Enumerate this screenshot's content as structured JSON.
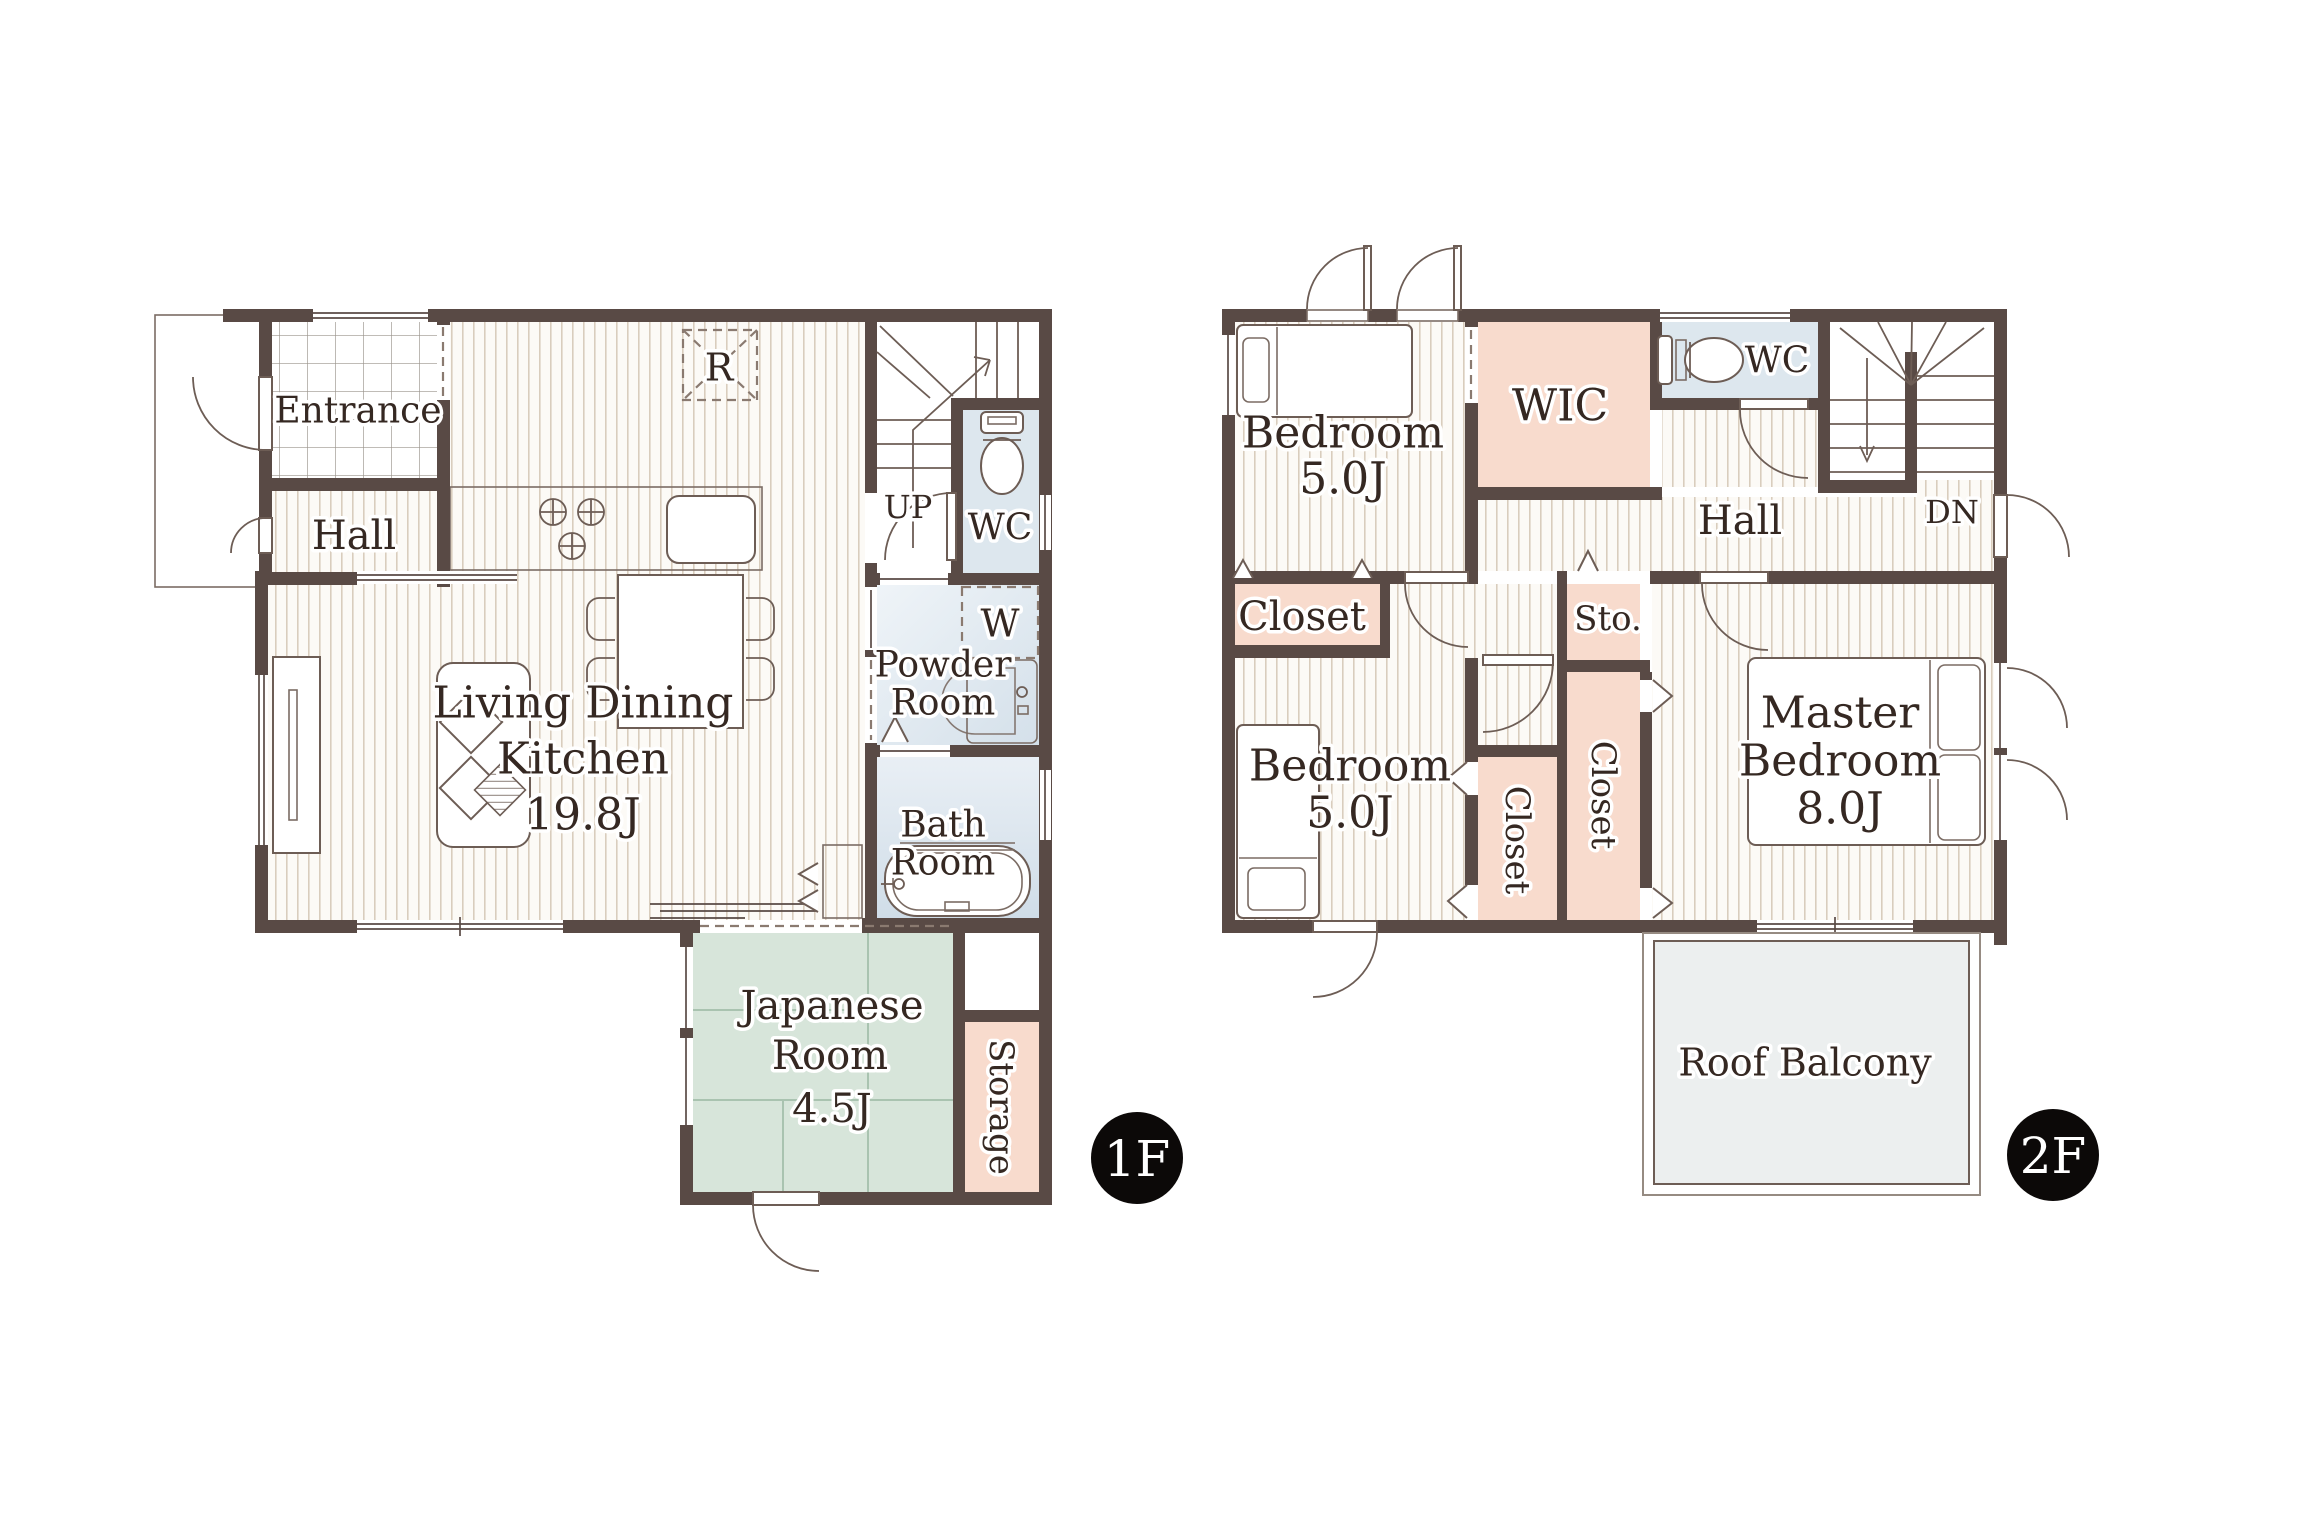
{
  "floor1": {
    "badge": "1F",
    "entrance": "Entrance",
    "hall": "Hall",
    "ldk1": "Living Dining",
    "ldk2": "Kitchen",
    "ldk3": "19.8J",
    "up": "UP",
    "wc": "WC",
    "fridge": "R",
    "washer": "W",
    "powder1": "Powder",
    "powder2": "Room",
    "bath1": "Bath",
    "bath2": "Room",
    "japanese1": "Japanese",
    "japanese2": "Room",
    "japanese3": "4.5J",
    "storage": "Storage"
  },
  "floor2": {
    "badge": "2F",
    "bedroom1a": "Bedroom",
    "bedroom1b": "5.0J",
    "wic": "WIC",
    "wc": "WC",
    "hall": "Hall",
    "dn": "DN",
    "closet1": "Closet",
    "sto": "Sto.",
    "bedroom2a": "Bedroom",
    "bedroom2b": "5.0J",
    "closet2": "Closet",
    "closet3": "Closet",
    "master1": "Master",
    "master2": "Bedroom",
    "master3": "8.0J",
    "balcony": "Roof Balcony"
  },
  "colors": {
    "wall": "#594a45",
    "text": "#352822",
    "tatami": "#d7e5da",
    "pink": "#f8dbcd",
    "blue": "#dde7ee",
    "counter": "#d9e4ec",
    "balcony": "#ecefef",
    "badge": "#0c0908"
  }
}
